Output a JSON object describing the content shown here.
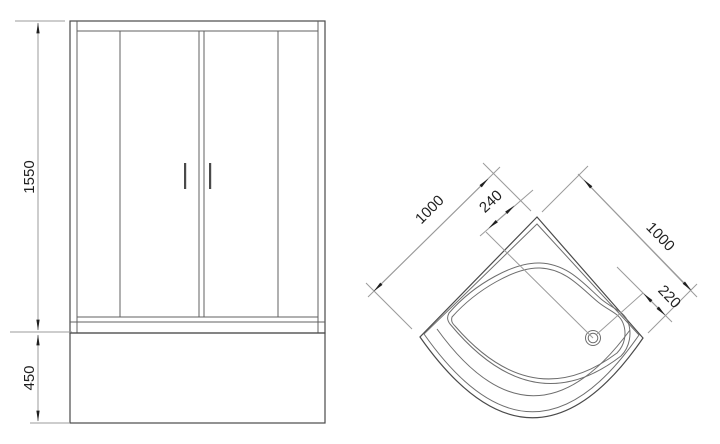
{
  "drawing": {
    "background": "#ffffff",
    "colors": {
      "main_line": "#4a4a4a",
      "secondary_line": "#6e6e6e",
      "dimension_line": "#9b9b9b",
      "text": "#1f1f1f"
    },
    "front_view": {
      "description": "shower-enclosure-front-elevation",
      "dimensions": {
        "door_height": "1550",
        "tray_height": "450"
      }
    },
    "top_view": {
      "description": "corner-shower-tray-plan",
      "dimensions": {
        "left_side": "1000",
        "right_side": "1000",
        "drain_offset_back": "240",
        "drain_offset_side": "220"
      }
    }
  }
}
